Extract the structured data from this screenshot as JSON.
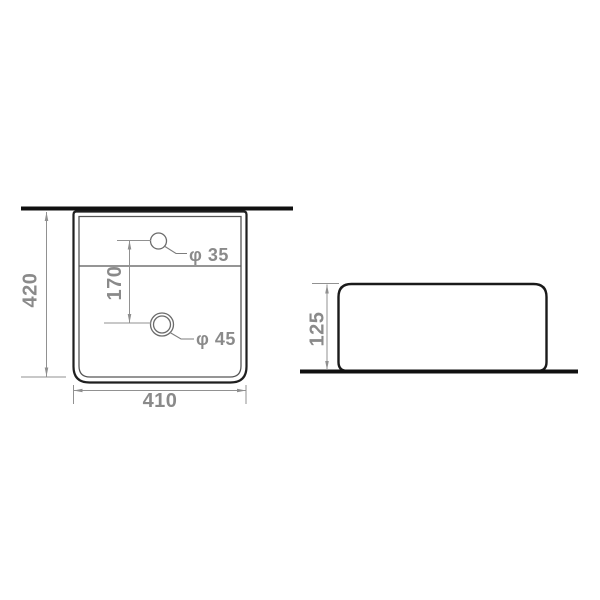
{
  "colors": {
    "background": "#ffffff",
    "outline": "#1f1f1f",
    "thick_line": "#101010",
    "dimension_line": "#919191",
    "dimension_text": "#8a8a8a"
  },
  "plan_view": {
    "overall_width_dim": "410",
    "overall_depth_dim": "420",
    "hole_spacing_dim": "170",
    "faucet_hole_label": "φ 35",
    "drain_hole_label": "φ 45"
  },
  "side_view": {
    "overall_height_dim": "125"
  }
}
